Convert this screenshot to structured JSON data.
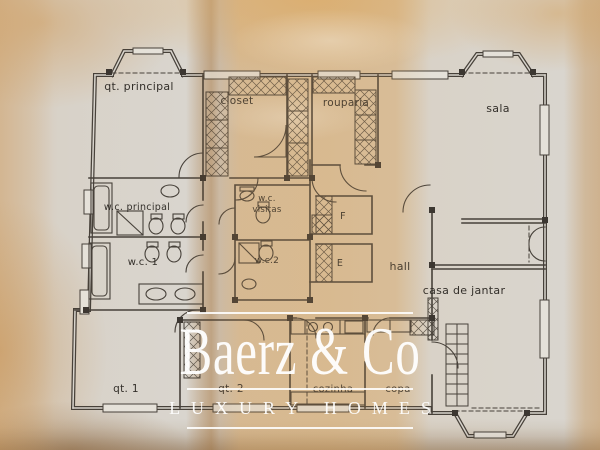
{
  "watermark": {
    "brand": "Baerz & Co",
    "tagline": "LUXURY HOMES",
    "color": "#ffffff"
  },
  "plan": {
    "colors": {
      "ink": "#3b352e",
      "paper": "#d9d5ce",
      "stain": "#d2a065"
    },
    "labels": {
      "qt_principal": "qt. principal",
      "closet": "closet",
      "rouparia": "rouparia",
      "sala": "sala",
      "wc_principal": "w.c. principal",
      "wc_visitas_line1": "w.c.",
      "wc_visitas_line2": "visitas",
      "lift_f": "F",
      "wc_1": "w.c. 1",
      "wc_2": "w.c.2",
      "lift_e": "E",
      "hall": "hall",
      "casa_de_jantar": "casa de jantar",
      "qt_1": "qt. 1",
      "qt_2": "qt. 2",
      "cozinha": "cozinha",
      "copa": "copa"
    }
  }
}
